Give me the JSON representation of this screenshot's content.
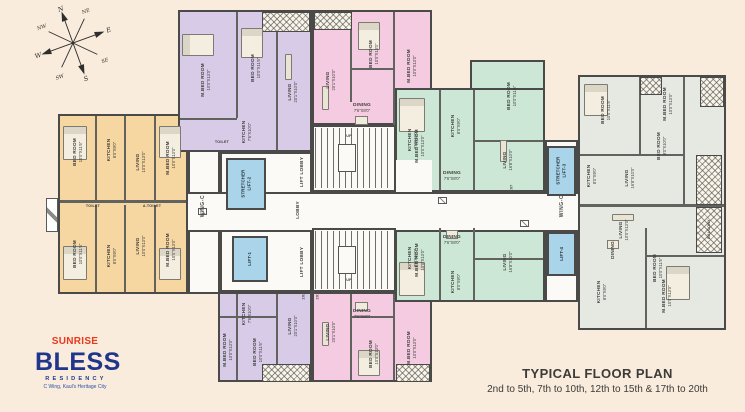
{
  "colors": {
    "background": "#f9ecdc",
    "wall": "#4a4a48",
    "wing_orange": "#f6d7a2",
    "wing_purple": "#d8cbe7",
    "wing_pink": "#f4cbe0",
    "wing_green": "#cde7d6",
    "wing_gray": "#e6e9e2",
    "lift_blue": "#aad4ea",
    "brand_red": "#e8391c",
    "brand_blue": "#20368c"
  },
  "compass": {
    "n": "N",
    "ne": "NE",
    "e": "E",
    "se": "SE",
    "s": "S",
    "sw": "SW",
    "w": "W",
    "nw": "NW"
  },
  "rooms": {
    "bed": "BED ROOM",
    "mbed": "M.BED ROOM",
    "living": "LIVING",
    "kitchen": "KITCHEN",
    "dining": "DINING",
    "toilet": "TOILET",
    "atoilet": "A.TOILET",
    "balcony": "BALCONY",
    "d_1013": "10'0\"X13'0\"",
    "d_1116": "10'0\"X11'6\"",
    "d_201": "20'1\"X10'0\"",
    "d_168": "16'8\"X10'0\"",
    "d_89": "8'0\"X9'0\"",
    "d_7610": "7'6\"X10'0\"",
    "d_768": "7'6\"X8'0\"",
    "d_810": "8'0\"X10'0\""
  },
  "core": {
    "wing": "WING-C",
    "lobby": "LOBBY",
    "lift_lobby": "LIFT LOBBY",
    "lift1": "LIFT-1",
    "lift2": "STRETCHER\nLIFT-2",
    "lift3": "STRETCHER\nLIFT-3",
    "lift4": "LIFT-4",
    "up": "UP",
    "tag_202": "202",
    "tag_201": "201",
    "tag_207": "207"
  },
  "footer": {
    "brand": "SUNRISE",
    "project": "BLESS",
    "project_sub": "RESIDENCY",
    "address": "C Wing, Kaul's Heritage City",
    "title": "TYPICAL FLOOR PLAN",
    "subtitle": "2nd to 5th, 7th to 10th, 12th to 15th & 17th to 20th"
  }
}
